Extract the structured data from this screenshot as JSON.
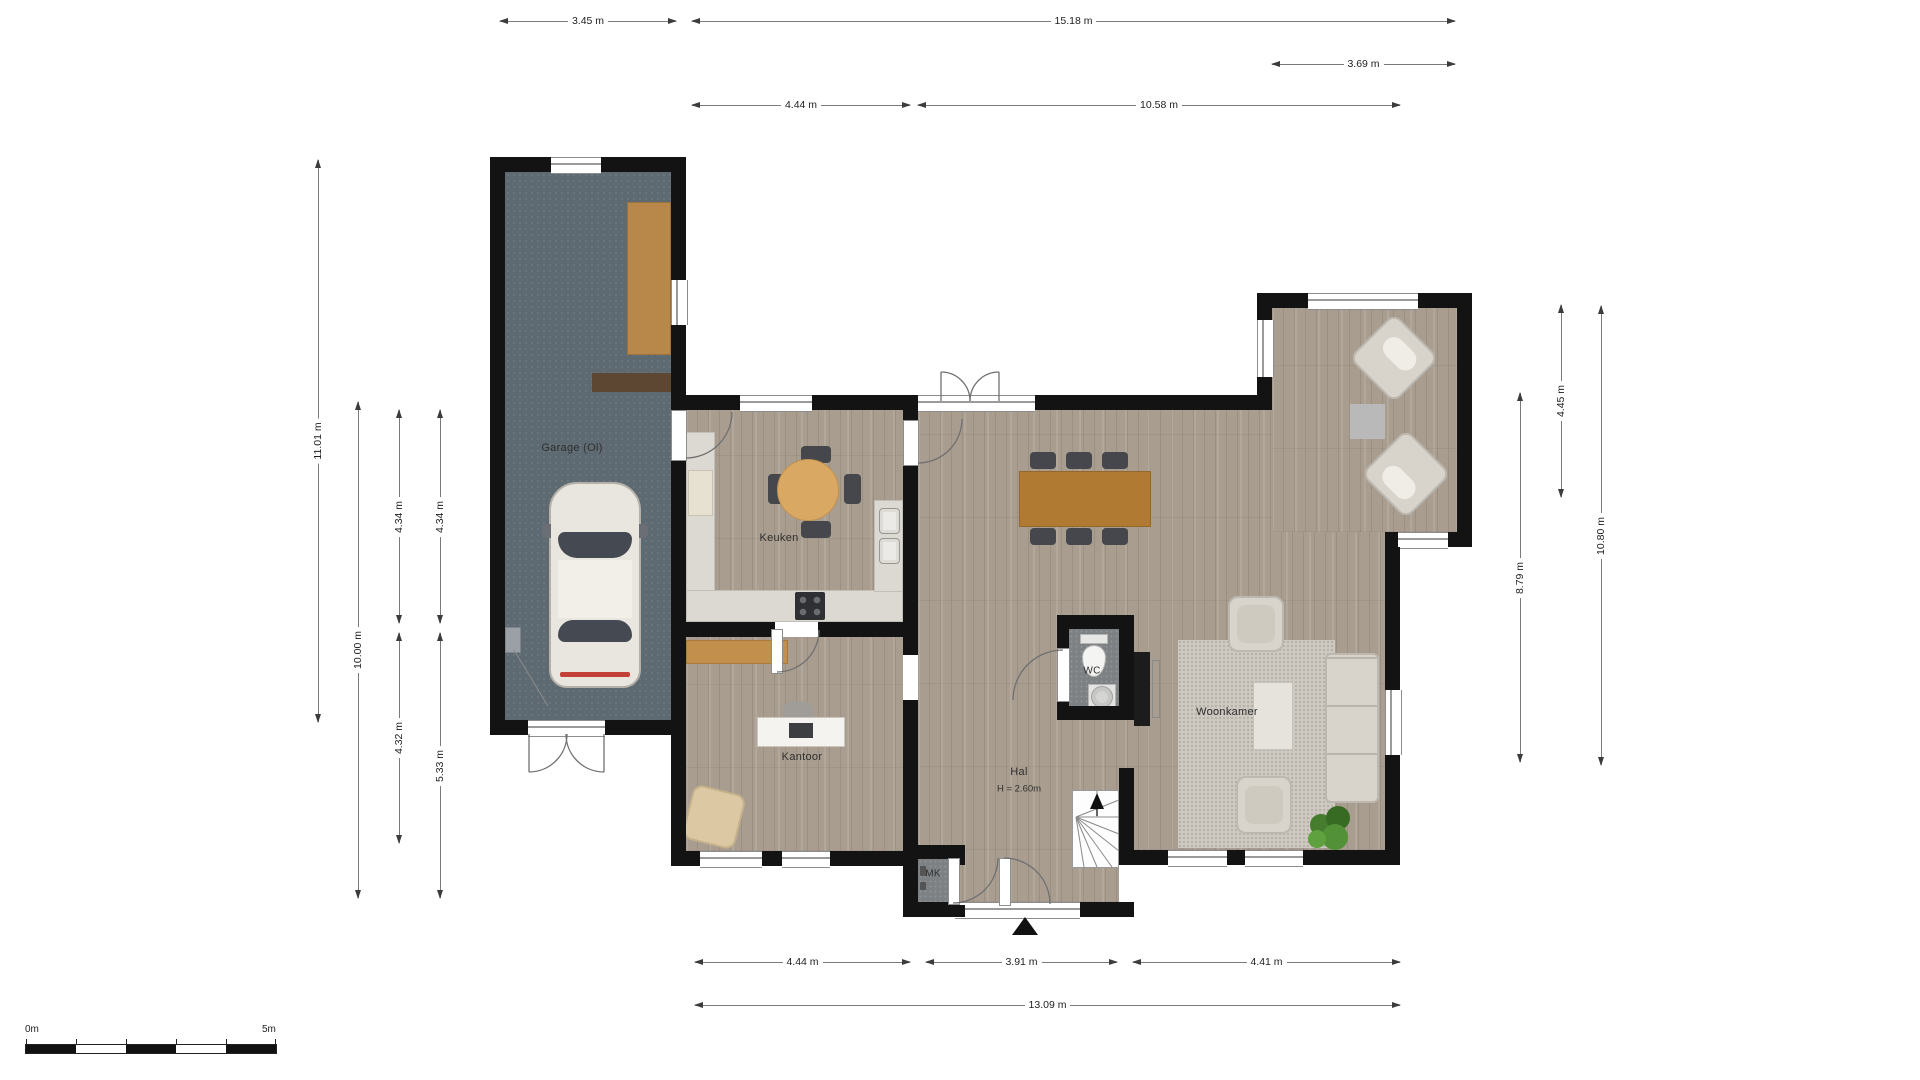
{
  "rooms": [
    {
      "id": "garage",
      "label": "Garage (Ol)"
    },
    {
      "id": "keuken",
      "label": "Keuken"
    },
    {
      "id": "kantoor",
      "label": "Kantoor"
    },
    {
      "id": "hal",
      "label": "Hal",
      "sub": "H = 2.60m"
    },
    {
      "id": "wc",
      "label": "WC"
    },
    {
      "id": "mk",
      "label": "MK"
    },
    {
      "id": "woonkamer",
      "label": "Woonkamer"
    }
  ],
  "dimensions": {
    "top": [
      {
        "label": "3.45 m"
      },
      {
        "label": "15.18 m"
      },
      {
        "label": "3.69 m"
      },
      {
        "label": "4.44 m"
      },
      {
        "label": "10.58 m"
      }
    ],
    "left": [
      {
        "label": "11.01 m"
      },
      {
        "label": "10.00 m"
      },
      {
        "label": "4.34 m"
      },
      {
        "label": "4.34 m"
      },
      {
        "label": "4.32 m"
      },
      {
        "label": "5.33 m"
      }
    ],
    "right": [
      {
        "label": "4.45 m"
      },
      {
        "label": "8.79 m"
      },
      {
        "label": "10.80 m"
      }
    ],
    "bottom": [
      {
        "label": "4.44 m"
      },
      {
        "label": "3.91 m"
      },
      {
        "label": "4.41 m"
      },
      {
        "label": "13.09 m"
      }
    ]
  },
  "scale_bar": {
    "start": "0m",
    "end": "5m"
  },
  "colors": {
    "wall": "#131313",
    "wood_floor": "#a89d8f",
    "garage_floor": "#5e6a72",
    "tile_floor": "#7d8184",
    "counter": "#dcd9d2",
    "dining_table": "#b07a33",
    "kitchen_table": "#d9a964",
    "sofa": "#d8d4cc",
    "plant": "#467c2d"
  }
}
